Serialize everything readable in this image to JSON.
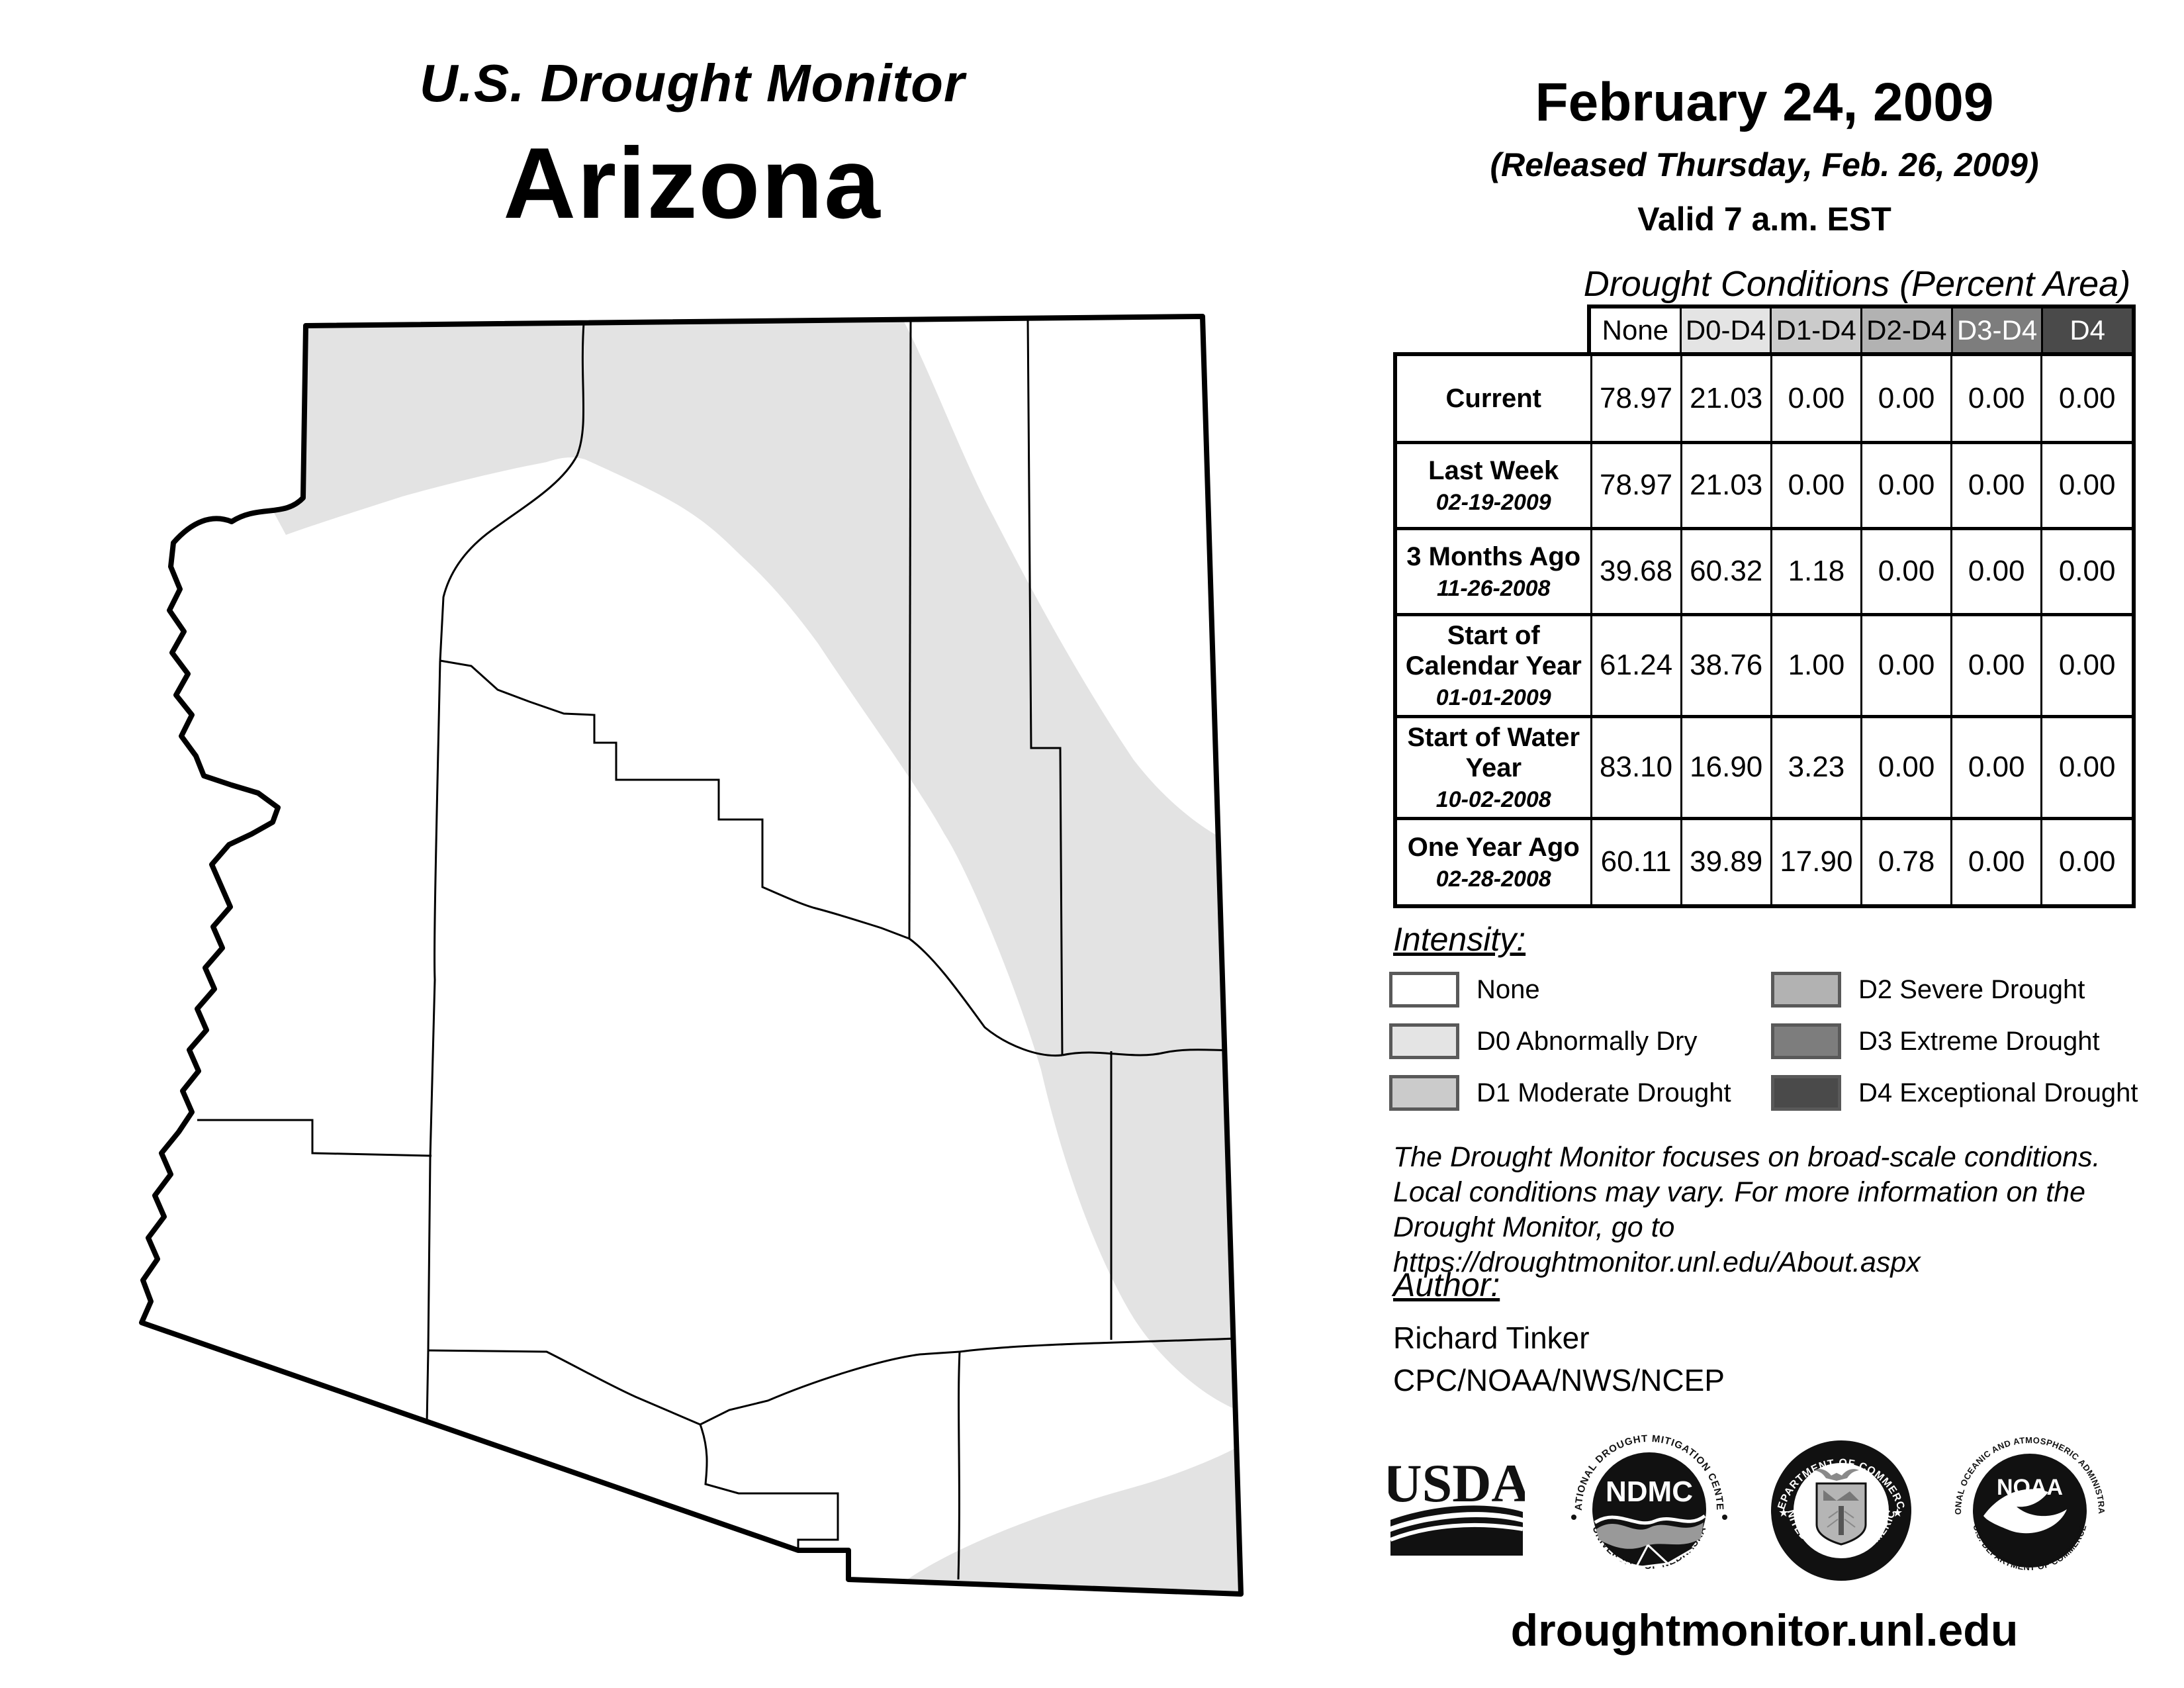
{
  "header": {
    "title": "U.S. Drought Monitor",
    "state": "Arizona"
  },
  "date_block": {
    "date": "February 24, 2009",
    "released": "(Released Thursday, Feb. 26, 2009)",
    "valid": "Valid 7 a.m. EST"
  },
  "table": {
    "title": "Drought Conditions (Percent Area)",
    "columns": [
      {
        "label": "None",
        "bg": "#ffffff",
        "fg": "#000000"
      },
      {
        "label": "D0-D4",
        "bg": "#e4e4e4",
        "fg": "#000000"
      },
      {
        "label": "D1-D4",
        "bg": "#cbcbcb",
        "fg": "#000000"
      },
      {
        "label": "D2-D4",
        "bg": "#b2b2b2",
        "fg": "#000000"
      },
      {
        "label": "D3-D4",
        "bg": "#7d7d7d",
        "fg": "#ffffff"
      },
      {
        "label": "D4",
        "bg": "#4a4a4a",
        "fg": "#ffffff"
      }
    ],
    "rows": [
      {
        "label": "Current",
        "date": "",
        "values": [
          "78.97",
          "21.03",
          "0.00",
          "0.00",
          "0.00",
          "0.00"
        ]
      },
      {
        "label": "Last Week",
        "date": "02-19-2009",
        "values": [
          "78.97",
          "21.03",
          "0.00",
          "0.00",
          "0.00",
          "0.00"
        ]
      },
      {
        "label": "3 Months Ago",
        "date": "11-26-2008",
        "values": [
          "39.68",
          "60.32",
          "1.18",
          "0.00",
          "0.00",
          "0.00"
        ]
      },
      {
        "label": "Start of Calendar Year",
        "date": "01-01-2009",
        "values": [
          "61.24",
          "38.76",
          "1.00",
          "0.00",
          "0.00",
          "0.00"
        ]
      },
      {
        "label": "Start of Water Year",
        "date": "10-02-2008",
        "values": [
          "83.10",
          "16.90",
          "3.23",
          "0.00",
          "0.00",
          "0.00"
        ]
      },
      {
        "label": "One Year Ago",
        "date": "02-28-2008",
        "values": [
          "60.11",
          "39.89",
          "17.90",
          "0.78",
          "0.00",
          "0.00"
        ]
      }
    ]
  },
  "legend": {
    "title": "Intensity:",
    "items": [
      {
        "label": "None",
        "color": "#ffffff"
      },
      {
        "label": "D0 Abnormally Dry",
        "color": "#e4e4e4"
      },
      {
        "label": "D1 Moderate Drought",
        "color": "#cbcbcb"
      },
      {
        "label": "D2 Severe Drought",
        "color": "#b2b2b2"
      },
      {
        "label": "D3 Extreme Drought",
        "color": "#7d7d7d"
      },
      {
        "label": "D4 Exceptional Drought",
        "color": "#4a4a4a"
      }
    ]
  },
  "disclaimer_lines": [
    "The Drought Monitor focuses on broad-scale conditions.",
    "Local conditions may vary. For more information on the",
    "Drought Monitor, go to https://droughtmonitor.unl.edu/About.aspx"
  ],
  "author": {
    "heading": "Author:",
    "name": "Richard Tinker",
    "org": "CPC/NOAA/NWS/NCEP"
  },
  "logos": {
    "usda": {
      "name": "USDA"
    },
    "ndmc": {
      "abbr": "NDMC",
      "ring_top": "NATIONAL DROUGHT MITIGATION CENTER",
      "ring_bottom": "UNIVERSITY OF NEBRASKA"
    },
    "commerce": {
      "ring_top": "DEPARTMENT OF COMMERCE",
      "ring_bottom": "UNITED STATES OF AMERICA"
    },
    "noaa": {
      "abbr": "NOAA",
      "ring_top": "NATIONAL OCEANIC AND ATMOSPHERIC ADMINISTRATION",
      "ring_bottom": "U.S. DEPARTMENT OF COMMERCE"
    }
  },
  "footer": {
    "url": "droughtmonitor.unl.edu"
  },
  "colors": {
    "map_d0": "#e3e3e3",
    "map_none": "#ffffff",
    "state_border": "#000000"
  }
}
